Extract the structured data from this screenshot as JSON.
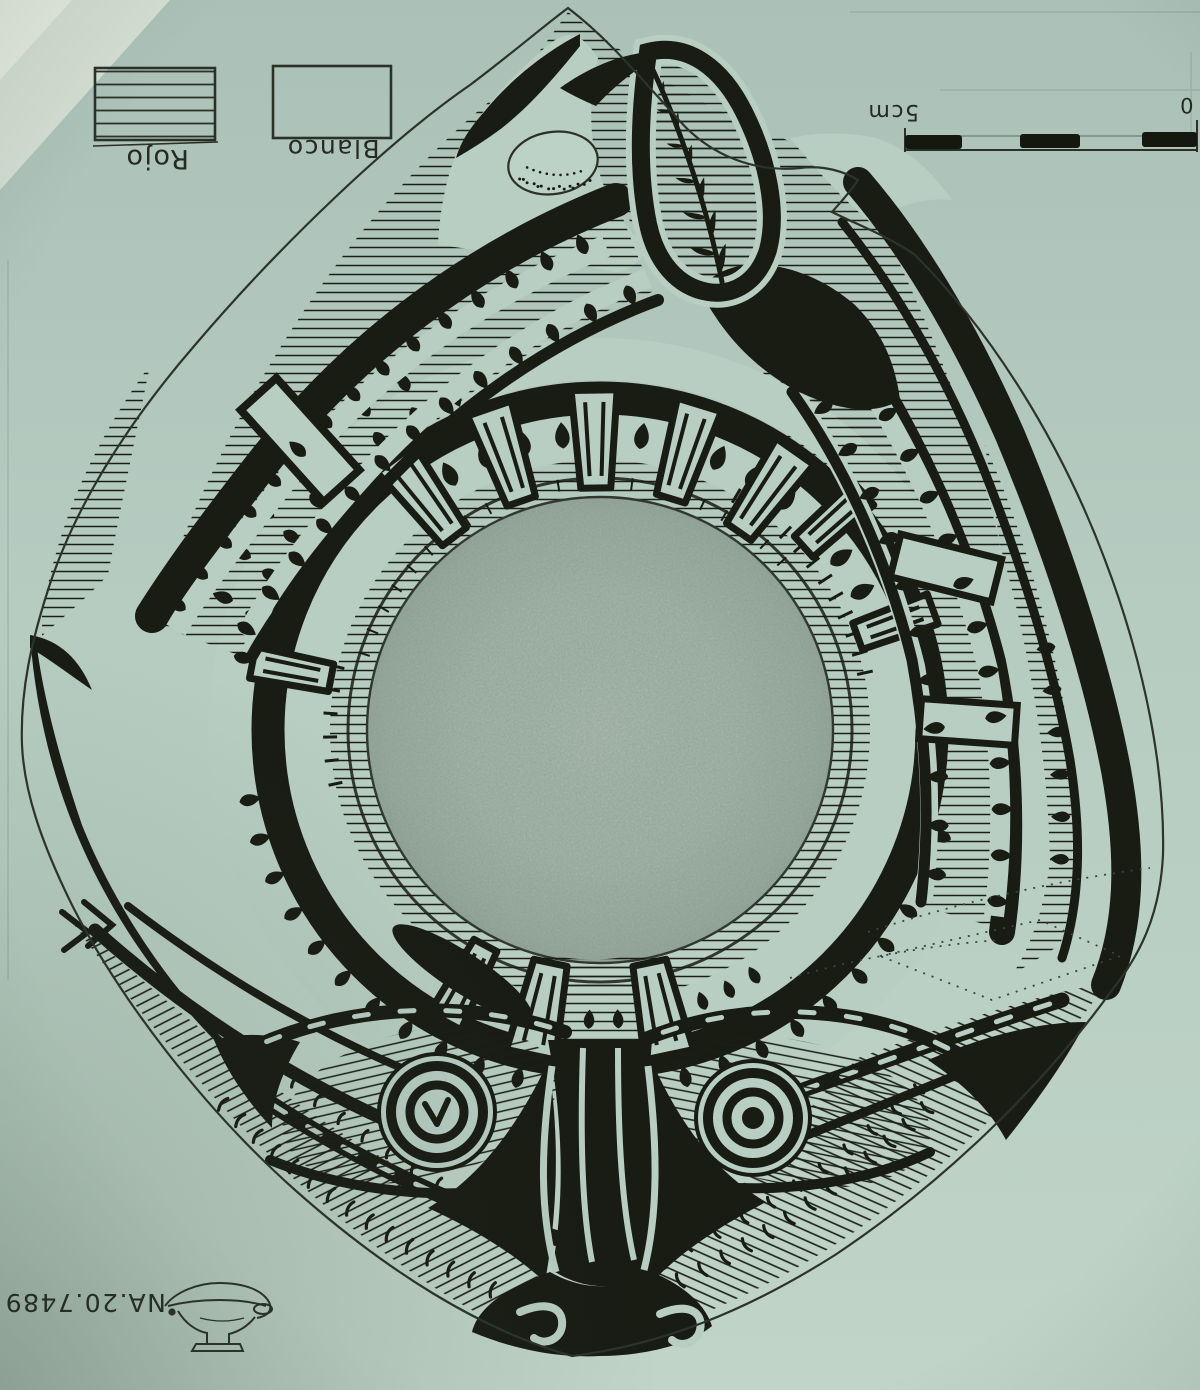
{
  "scan": {
    "title": "Hand-drawn archaeological illustration of a painted vessel interior (scanned sheet, annotations upside-down)",
    "colors": {
      "paper": "#b6ccc1",
      "paper_shade": "#aec4ba",
      "paper_bright": "#d9e3d6",
      "ink": "#191c13",
      "graphite": "#9fb2a7",
      "pencil_line": "#3a443c"
    }
  },
  "legend": {
    "items": [
      {
        "label": "Rojo",
        "swatch": "hatched"
      },
      {
        "label": "Blanco",
        "swatch": "blank"
      }
    ]
  },
  "scale_bar": {
    "length_label": "5cm",
    "zero_label": "0",
    "segments": 5
  },
  "annotations": {
    "catalog_number": "NA.20.7489"
  },
  "motifs": {
    "center": "graphite-shaded-medallion",
    "top": "fern-feather-in-teardrop-loop",
    "top_left": "stippled-oval",
    "sides": "hatched-crescent-bands-with-teardrop-dots",
    "bottom": "double-eye-face-with-scroll-anchor",
    "corner_sketch": "vessel-profile-side-view"
  }
}
